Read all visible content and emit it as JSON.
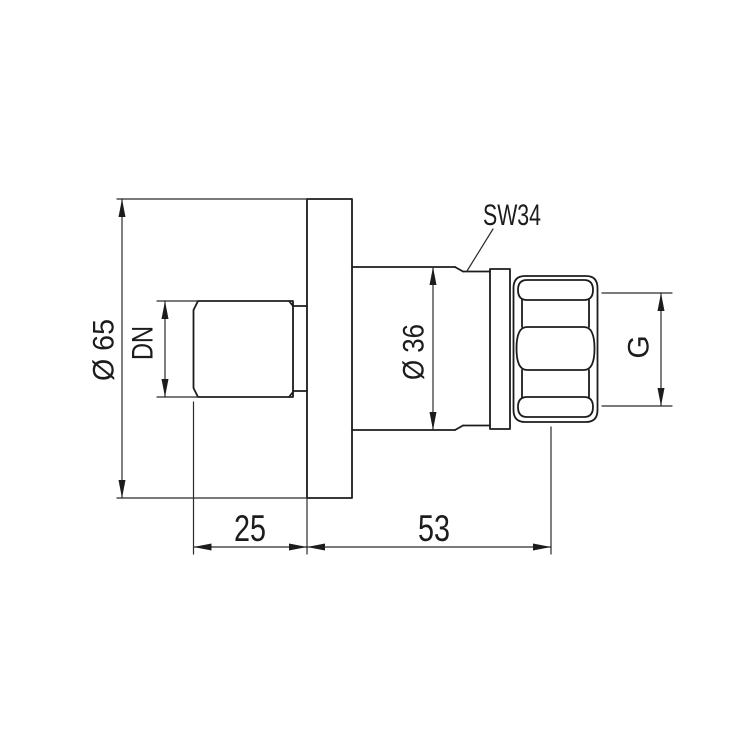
{
  "drawing": {
    "background_color": "#ffffff",
    "line_color": "#1c1c1c",
    "labels": {
      "dia65": "Ø 65",
      "dn": "DN",
      "dia36": "Ø 36",
      "sw34": "SW34",
      "g": "G",
      "dim25": "25",
      "dim53": "53"
    }
  }
}
